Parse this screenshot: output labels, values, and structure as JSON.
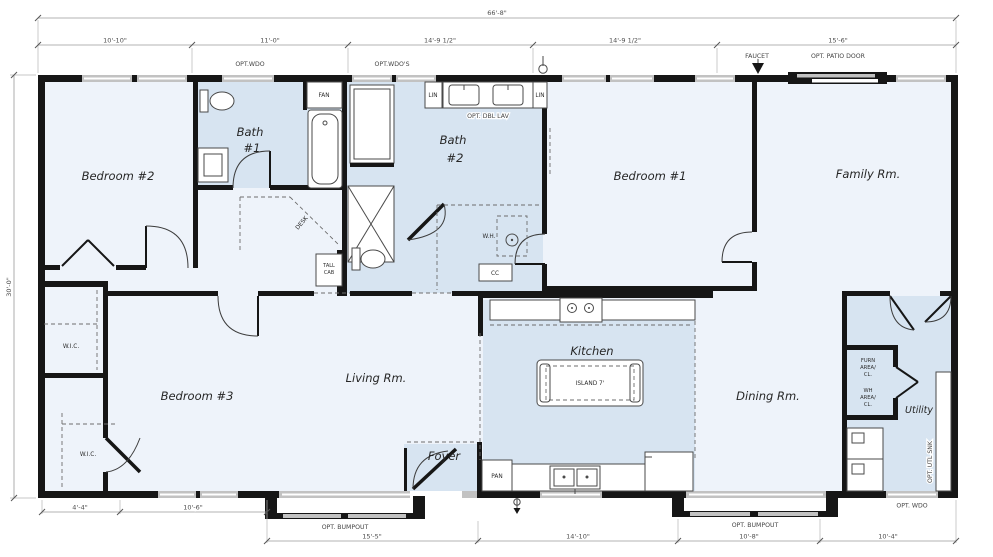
{
  "drawing": {
    "overall_width_label": "66'-8\"",
    "overall_depth_label": "30'-0\"",
    "top_dims": [
      "10'-10\"",
      "11'-0\"",
      "14'-9 1/2\"",
      "14'-9 1/2\"",
      "15'-6\""
    ],
    "bottom_dims_left": [
      "4'-4\"",
      "10'-6\""
    ],
    "bottom_dims": [
      "15'-5\"",
      "14'-10\"",
      "10'-8\"",
      "10'-4\""
    ]
  },
  "rooms": {
    "bedroom2": "Bedroom #2",
    "bath1_line1": "Bath",
    "bath1_line2": "#1",
    "bath2_line1": "Bath",
    "bath2_line2": "#2",
    "bedroom1": "Bedroom #1",
    "family": "Family Rm.",
    "wic_upper": "W.I.C.",
    "wic_lower": "W.I.C.",
    "bedroom3": "Bedroom #3",
    "living": "Living Rm.",
    "kitchen": "Kitchen",
    "foyer": "Foyer",
    "dining": "Dining Rm.",
    "utility": "Utility"
  },
  "fixtures": {
    "island": "ISLAND 7'",
    "pantry": "PAN",
    "fan": "FAN",
    "lin_left": "LIN",
    "lin_right": "LIN",
    "water_heater": "W.H.",
    "cc": "CC",
    "tall_cab_line1": "TALL",
    "tall_cab_line2": "CAB",
    "desk": "DESK",
    "furn_line1": "FURN",
    "furn_line2": "AREA/",
    "furn_line3": "CL.",
    "wh_line1": "WH",
    "wh_line2": "AREA/",
    "wh_line3": "CL."
  },
  "options": {
    "opt_wdo_top": "OPT.WDO",
    "opt_wdos_top": "OPT.WDO'S",
    "opt_dbl_lav": "OPT. DBL LAV",
    "faucet": "FAUCET",
    "opt_patio_door": "OPT. PATIO DOOR",
    "opt_bumpout_left": "OPT. BUMPOUT",
    "opt_bumpout_right": "OPT. BUMPOUT",
    "opt_utl_snk": "OPT. UTL SNK",
    "opt_wdo_bottom": "OPT. WDO"
  }
}
